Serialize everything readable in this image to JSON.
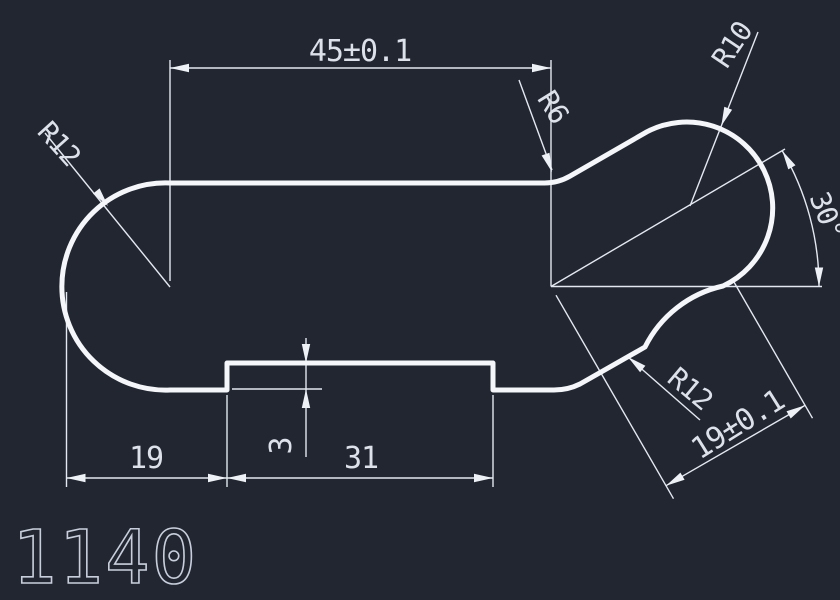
{
  "colors": {
    "background": "#212631",
    "outline_stroke": "#f4f6f9",
    "dimension_stroke": "#e4e8f0",
    "text_color": "#dce1ea"
  },
  "drawing": {
    "part_number": "1140",
    "dimensions": {
      "top_length": "45±0.1",
      "left_end_radius": "R12",
      "top_fillet_radius": "R6",
      "lobe_radius": "R10",
      "lobe_angle": "30°",
      "center_distance": "19±0.1",
      "cove_radius": "R12",
      "bottom_left_offset": "19",
      "notch_width": "31",
      "notch_depth": "3"
    }
  }
}
